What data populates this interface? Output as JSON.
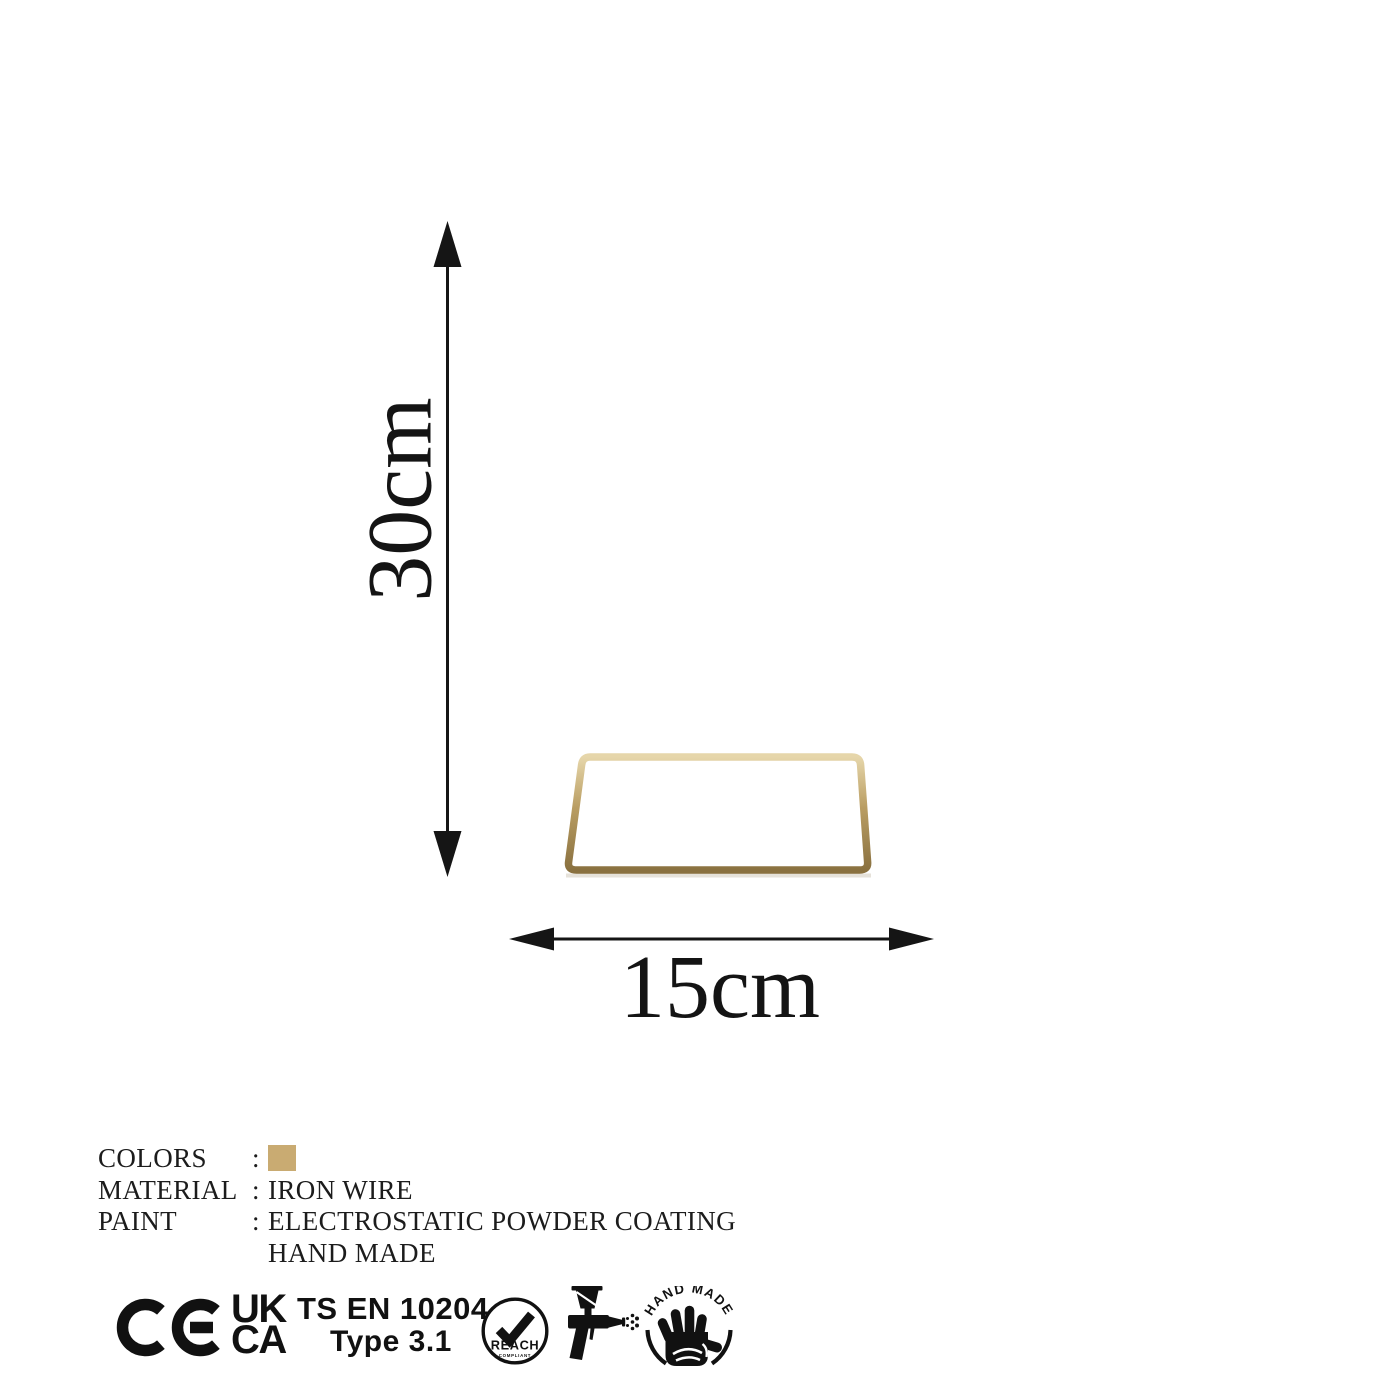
{
  "product_diagram": {
    "name": "jewelry-stand-dimension-diagram",
    "height_label": "30cm",
    "width_label": "15cm"
  },
  "colors": {
    "gold_mid": "#b99d62",
    "gold_light": "#e3d3a6",
    "gold_dark": "#8a7140",
    "swatch": "#c9ab72",
    "ink": "#111111",
    "background": "#ffffff"
  },
  "specs": {
    "separator": ":",
    "rows": [
      {
        "label": "COLORS",
        "value": ""
      },
      {
        "label": "MATERIAL",
        "value": "IRON WIRE"
      },
      {
        "label": "PAINT",
        "value": "ELECTROSTATIC POWDER COATING"
      },
      {
        "label": "",
        "value": "HAND MADE"
      }
    ]
  },
  "certifications": {
    "ce_mark": "CE",
    "ukca_line1": "UK",
    "ukca_line2": "CA",
    "standard_line1": "TS EN 10204",
    "standard_line2": "Type 3.1",
    "reach_label": "REACH",
    "reach_sub": "COMPLIANT",
    "handmade_label": "HAND MADE"
  }
}
